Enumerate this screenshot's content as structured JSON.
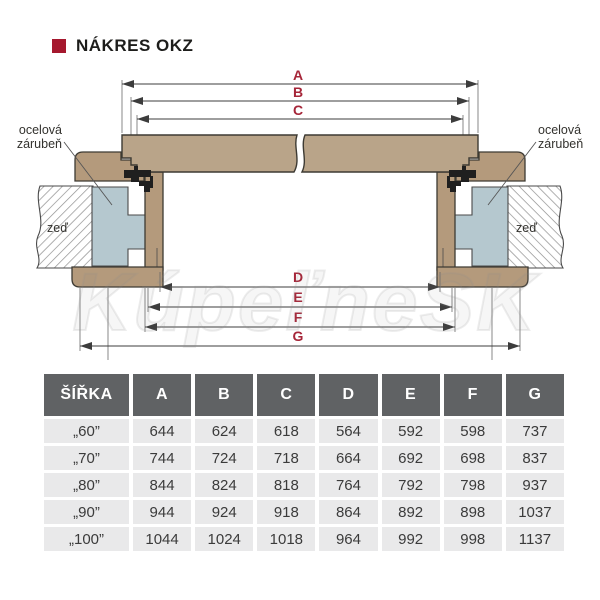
{
  "title": {
    "text": "NÁKRES OKZ"
  },
  "diagram": {
    "dim_letters": [
      "A",
      "B",
      "C",
      "D",
      "E",
      "F",
      "G"
    ],
    "labels": {
      "steel_frame_line1": "ocelová",
      "steel_frame_line2": "zárubeň",
      "wall": "zeď"
    },
    "colors": {
      "dimension_label": "#a62639",
      "title_bullet": "#a5182e",
      "door_leaf_wood": "#b9a489",
      "casing_wood": "#b49a7c",
      "steel_frame": "#b5c8cf",
      "table_header_bg": "#606264",
      "table_row_bg": "#e9e9ea"
    }
  },
  "watermark": {
    "text": "KúpeľneSK"
  },
  "table": {
    "headers": [
      "ŠÍŘKA",
      "A",
      "B",
      "C",
      "D",
      "E",
      "F",
      "G"
    ],
    "rows": [
      [
        "„60”",
        "644",
        "624",
        "618",
        "564",
        "592",
        "598",
        "737"
      ],
      [
        "„70”",
        "744",
        "724",
        "718",
        "664",
        "692",
        "698",
        "837"
      ],
      [
        "„80”",
        "844",
        "824",
        "818",
        "764",
        "792",
        "798",
        "937"
      ],
      [
        "„90”",
        "944",
        "924",
        "918",
        "864",
        "892",
        "898",
        "1037"
      ],
      [
        "„100”",
        "1044",
        "1024",
        "1018",
        "964",
        "992",
        "998",
        "1137"
      ]
    ]
  }
}
